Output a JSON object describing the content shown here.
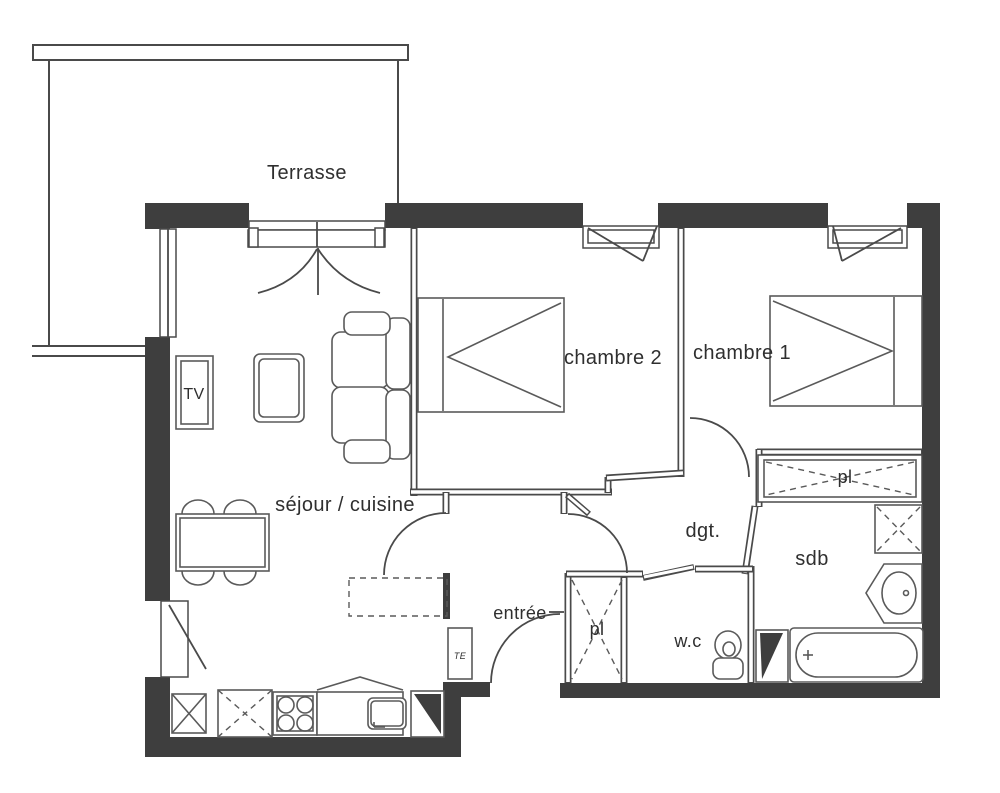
{
  "colors": {
    "wall": "#3e3e3e",
    "line": "#4a4a4a",
    "furniture_line": "#5a5a5a",
    "text": "#2f2f2f",
    "background": "#ffffff"
  },
  "rooms": {
    "terrace": "Terrasse",
    "living_kitchen": "séjour / cuisine",
    "bedroom2": "chambre 2",
    "bedroom1": "chambre 1",
    "entry": "entrée",
    "hallway": "dgt.",
    "toilet": "w.c",
    "bathroom": "sdb",
    "closet_hallway": "pl",
    "closet_entry": "pl"
  },
  "fixtures": {
    "tv_label": "TV",
    "electrical_panel_label": "TE"
  }
}
